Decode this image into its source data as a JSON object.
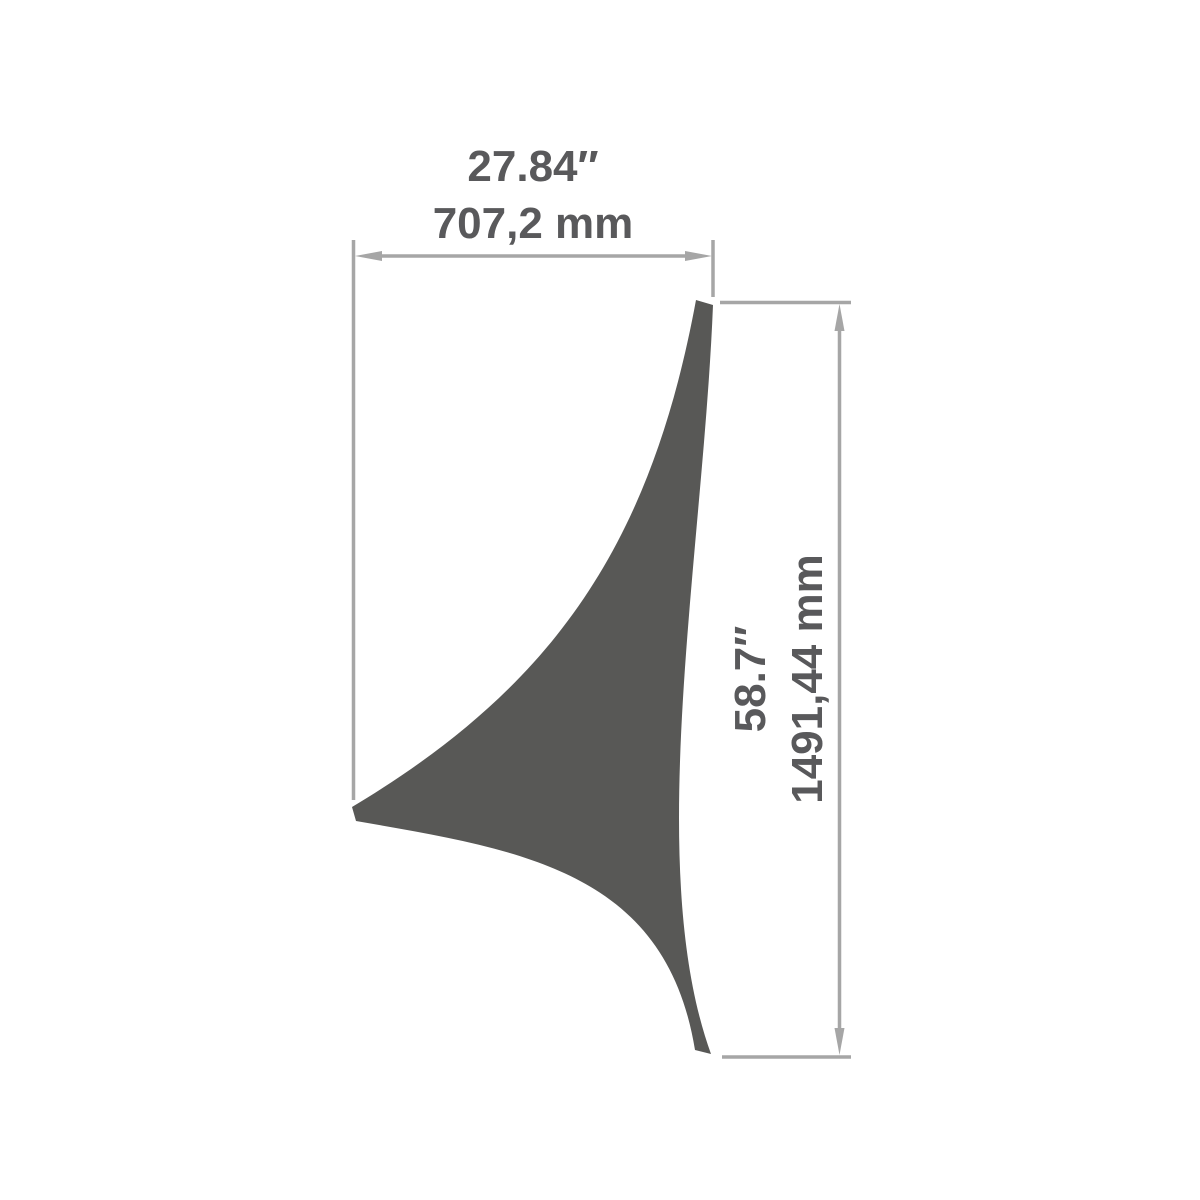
{
  "colors": {
    "background": "#ffffff",
    "sail_fill": "#585856",
    "dimension_lines": "#a6a6a6",
    "label_text": "#59595b"
  },
  "dimensions": {
    "width": {
      "inches": "27.84″",
      "millimeters": "707,2 mm"
    },
    "height": {
      "inches": "58.7″",
      "millimeters": "1491,44 mm"
    }
  }
}
